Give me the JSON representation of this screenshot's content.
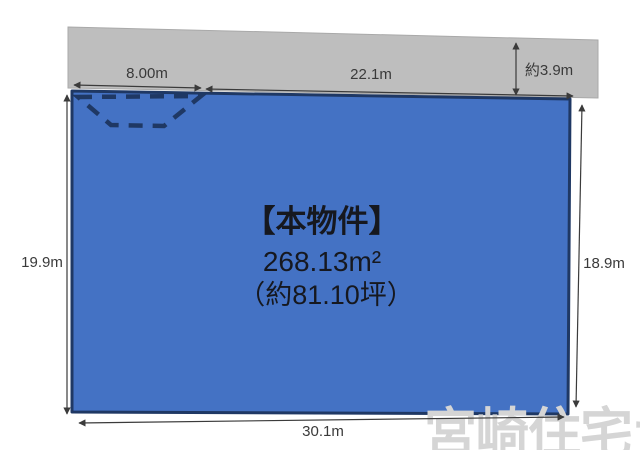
{
  "diagram": {
    "dimensions": {
      "frontage_left": "8.00m",
      "frontage_right": "22.1m",
      "road_depth": "約3.9m",
      "side_left": "19.9m",
      "side_right": "18.9m",
      "bottom_width": "30.1m"
    },
    "property": {
      "label": "【本物件】",
      "area_m2": "268.13m²",
      "area_tsubo": "（約81.10坪）"
    },
    "watermark": "宮崎住宅ナビ",
    "colors": {
      "plot_fill": "#4472C4",
      "plot_border": "#1F3864",
      "road_fill": "#BEBEBE",
      "dashed_area": "#1F3864",
      "dimension_line": "#3B3B3B",
      "label_text": "#3A3A3A",
      "property_text": "#16181F",
      "watermark": "#D5D5D5"
    }
  }
}
